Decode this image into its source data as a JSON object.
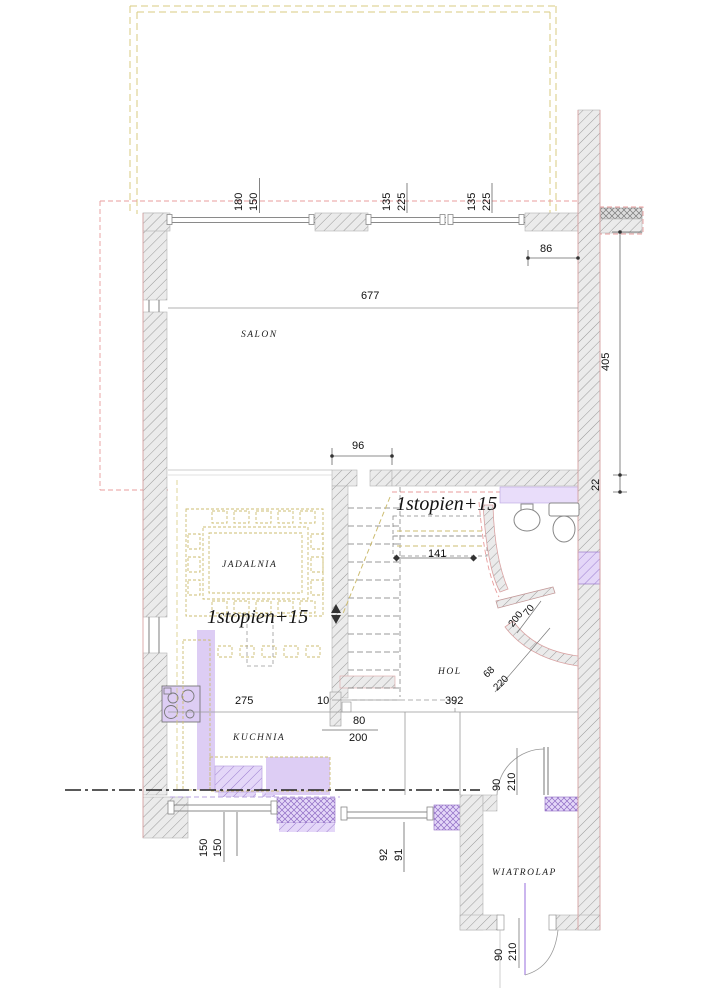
{
  "rooms": {
    "salon": "SALON",
    "jadalnia": "JADALNIA",
    "kuchnia": "KUCHNIA",
    "hol": "HOL",
    "wiatrolap": "WIATROLAP"
  },
  "notes": {
    "upper": "1stopien+15",
    "lower": "1stopien+15"
  },
  "dims": {
    "win1_a": "180",
    "win1_b": "150",
    "win2_a": "135",
    "win2_b": "225",
    "win3_a": "135",
    "win3_b": "225",
    "offset": "86",
    "salon_width": "677",
    "right_height": "405",
    "right_offset": "22",
    "stair_opening": "96",
    "steps_width": "141",
    "kitchen_width": "275",
    "stub": "10",
    "hall_width": "392",
    "kitchen_door_w": "80",
    "kitchen_door_h": "200",
    "bath_door_w": "70",
    "bath_door_h": "200",
    "bath_wall_w": "68",
    "bath_wall_h": "220",
    "side_door_w": "90",
    "side_door_h": "210",
    "entry_door_w": "90",
    "entry_door_h": "210",
    "win_bl_a": "150",
    "win_bl_b": "150",
    "win_bm_a": "92",
    "win_bm_b": "91"
  },
  "colors": {
    "wall_fill": "#ebebeb",
    "wall_hatch": "#9a9a9a",
    "wall_edge_pink": "#d9a3a3",
    "purple_fill": "#e4d7f8",
    "purple_hatch": "#9d7fd1",
    "lavender": "#ddcdf4",
    "tan_dash": "#cdbd72",
    "pink_dash": "#e89c9c"
  }
}
